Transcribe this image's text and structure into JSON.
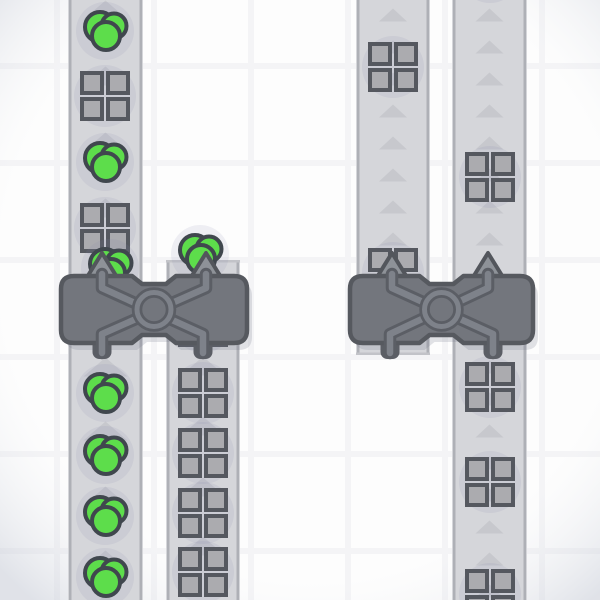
{
  "meta": {
    "app": "factory-belt-view",
    "canvas_w": 600,
    "canvas_h": 600
  },
  "colors": {
    "bg_tile": "#fdfdfd",
    "bg_line": "#f4f4f6",
    "vignette": "rgba(195,200,212,0.5)",
    "belt_fill": "#d5d6da",
    "belt_edge": "#aeb0b6",
    "belt_cap_edge": "#c2c3c8",
    "belt_arrow": "#c7c8cd",
    "item_shadow": "rgba(130,132,170,0.12)",
    "green_fill": "#5ddd4b",
    "green_stroke": "#40474e",
    "square_fill": "#ababaf",
    "square_stroke": "#55585f",
    "machine_fill": "#73767d",
    "machine_stroke": "#56595f",
    "machine_line_dark": "#5b5e65",
    "machine_line_light": "#7e828a",
    "machine_arrow_fill": "#8e9298",
    "machine_arrow_stroke": "#53565c",
    "pipe_fill": "#c7c8ce",
    "pipe_stroke": "#5b5e65",
    "machine_shadow": "rgba(110,115,135,0.2)"
  },
  "grid": {
    "offset_x": 57,
    "offset_y": 66,
    "period": 97,
    "line_width": 6
  },
  "geometry": {
    "arrow_large": {
      "w": 44,
      "h": 19
    },
    "arrow_small": {
      "w": 28,
      "h": 13
    },
    "square_cell": 20,
    "square_offset": 23,
    "square_stroke_w": 4,
    "cluster_circles": [
      [
        -5,
        -4,
        15
      ],
      [
        9,
        -5,
        12.5
      ],
      [
        1,
        5,
        14
      ]
    ],
    "shadow_r_square": 31,
    "shadow_r_cluster": 29,
    "machine_notch": {
      "half_outer": 22,
      "half_inner": 12,
      "depth": 8,
      "corner_r": 13
    },
    "machine_arrow": {
      "half_w": 18,
      "tip_y": 253
    },
    "pipe": {
      "w": 15,
      "h": 19,
      "top": 338,
      "rx": 5
    }
  },
  "belts": [
    {
      "id": "belt-left-a",
      "x": 68,
      "width": 75,
      "y0": 0,
      "y1": 600,
      "arrow_size": "large",
      "arrows_y": [
        10,
        76,
        142,
        208,
        367,
        431,
        496,
        560,
        604
      ]
    },
    {
      "id": "belt-left-b",
      "x": 166,
      "width": 74,
      "y0": 260,
      "y1": 600,
      "arrow_size": "large",
      "arrows_y": [
        366,
        426,
        487,
        546
      ],
      "cap_top": true
    },
    {
      "id": "belt-right-c",
      "x": 356,
      "width": 74,
      "y0": 0,
      "y1": 355,
      "arrow_size": "small",
      "arrows_y": [
        15,
        47,
        79,
        111,
        143,
        175,
        207,
        239,
        271
      ],
      "cap_bottom": true
    },
    {
      "id": "belt-right-d",
      "x": 452,
      "width": 75,
      "y0": 0,
      "y1": 600,
      "arrow_size": "small",
      "arrows_y": [
        15,
        47,
        79,
        111,
        143,
        175,
        207,
        239,
        271,
        367,
        399,
        431,
        463,
        495,
        527,
        559,
        591
      ]
    }
  ],
  "items": [
    {
      "type": "circle_cluster",
      "x": 105,
      "y": 31
    },
    {
      "type": "window_square",
      "x": 105,
      "y": 96
    },
    {
      "type": "circle_cluster",
      "x": 105,
      "y": 162
    },
    {
      "type": "window_square",
      "x": 105,
      "y": 228
    },
    {
      "type": "circle_cluster",
      "x": 110,
      "y": 268
    },
    {
      "type": "circle_cluster",
      "x": 105,
      "y": 393
    },
    {
      "type": "circle_cluster",
      "x": 105,
      "y": 455
    },
    {
      "type": "circle_cluster",
      "x": 105,
      "y": 516
    },
    {
      "type": "circle_cluster",
      "x": 105,
      "y": 577
    },
    {
      "type": "circle_cluster",
      "x": 200,
      "y": 254
    },
    {
      "type": "window_square",
      "x": 203,
      "y": 322
    },
    {
      "type": "window_square",
      "x": 203,
      "y": 393
    },
    {
      "type": "window_square",
      "x": 203,
      "y": 453
    },
    {
      "type": "window_square",
      "x": 203,
      "y": 513
    },
    {
      "type": "window_square",
      "x": 203,
      "y": 572
    },
    {
      "type": "window_square",
      "x": 393,
      "y": 67
    },
    {
      "type": "window_square",
      "x": 393,
      "y": 273
    },
    {
      "type": "shadow_only",
      "x": 490,
      "y": -27
    },
    {
      "type": "window_square",
      "x": 490,
      "y": 177
    },
    {
      "type": "window_square",
      "x": 490,
      "y": 387
    },
    {
      "type": "window_square",
      "x": 490,
      "y": 482
    },
    {
      "type": "window_square",
      "x": 490,
      "y": 594
    }
  ],
  "machines": [
    {
      "id": "balancer-left",
      "x": 61,
      "y": 276,
      "w": 186,
      "h": 67,
      "arrows_x": [
        102,
        206
      ],
      "pipes_x": [
        102,
        203
      ]
    },
    {
      "id": "balancer-right",
      "x": 350,
      "y": 276,
      "w": 183,
      "h": 67,
      "arrows_x": [
        392,
        488
      ],
      "pipes_x": [
        390,
        493
      ]
    }
  ]
}
